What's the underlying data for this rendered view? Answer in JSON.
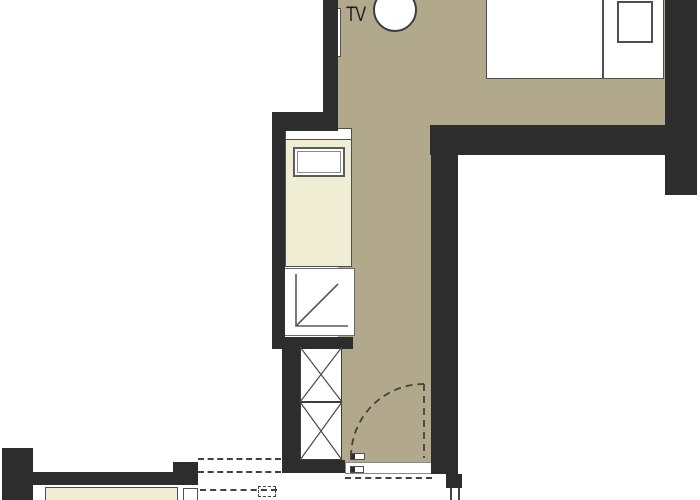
{
  "plan": {
    "tv_label": "TV"
  },
  "colors": {
    "paper": "#ffffff",
    "wall": "#2d2d2d",
    "floor": "#b2a98c",
    "furniture": "#efedd3",
    "line": "#4f4f4f",
    "dash": "#45423a"
  }
}
